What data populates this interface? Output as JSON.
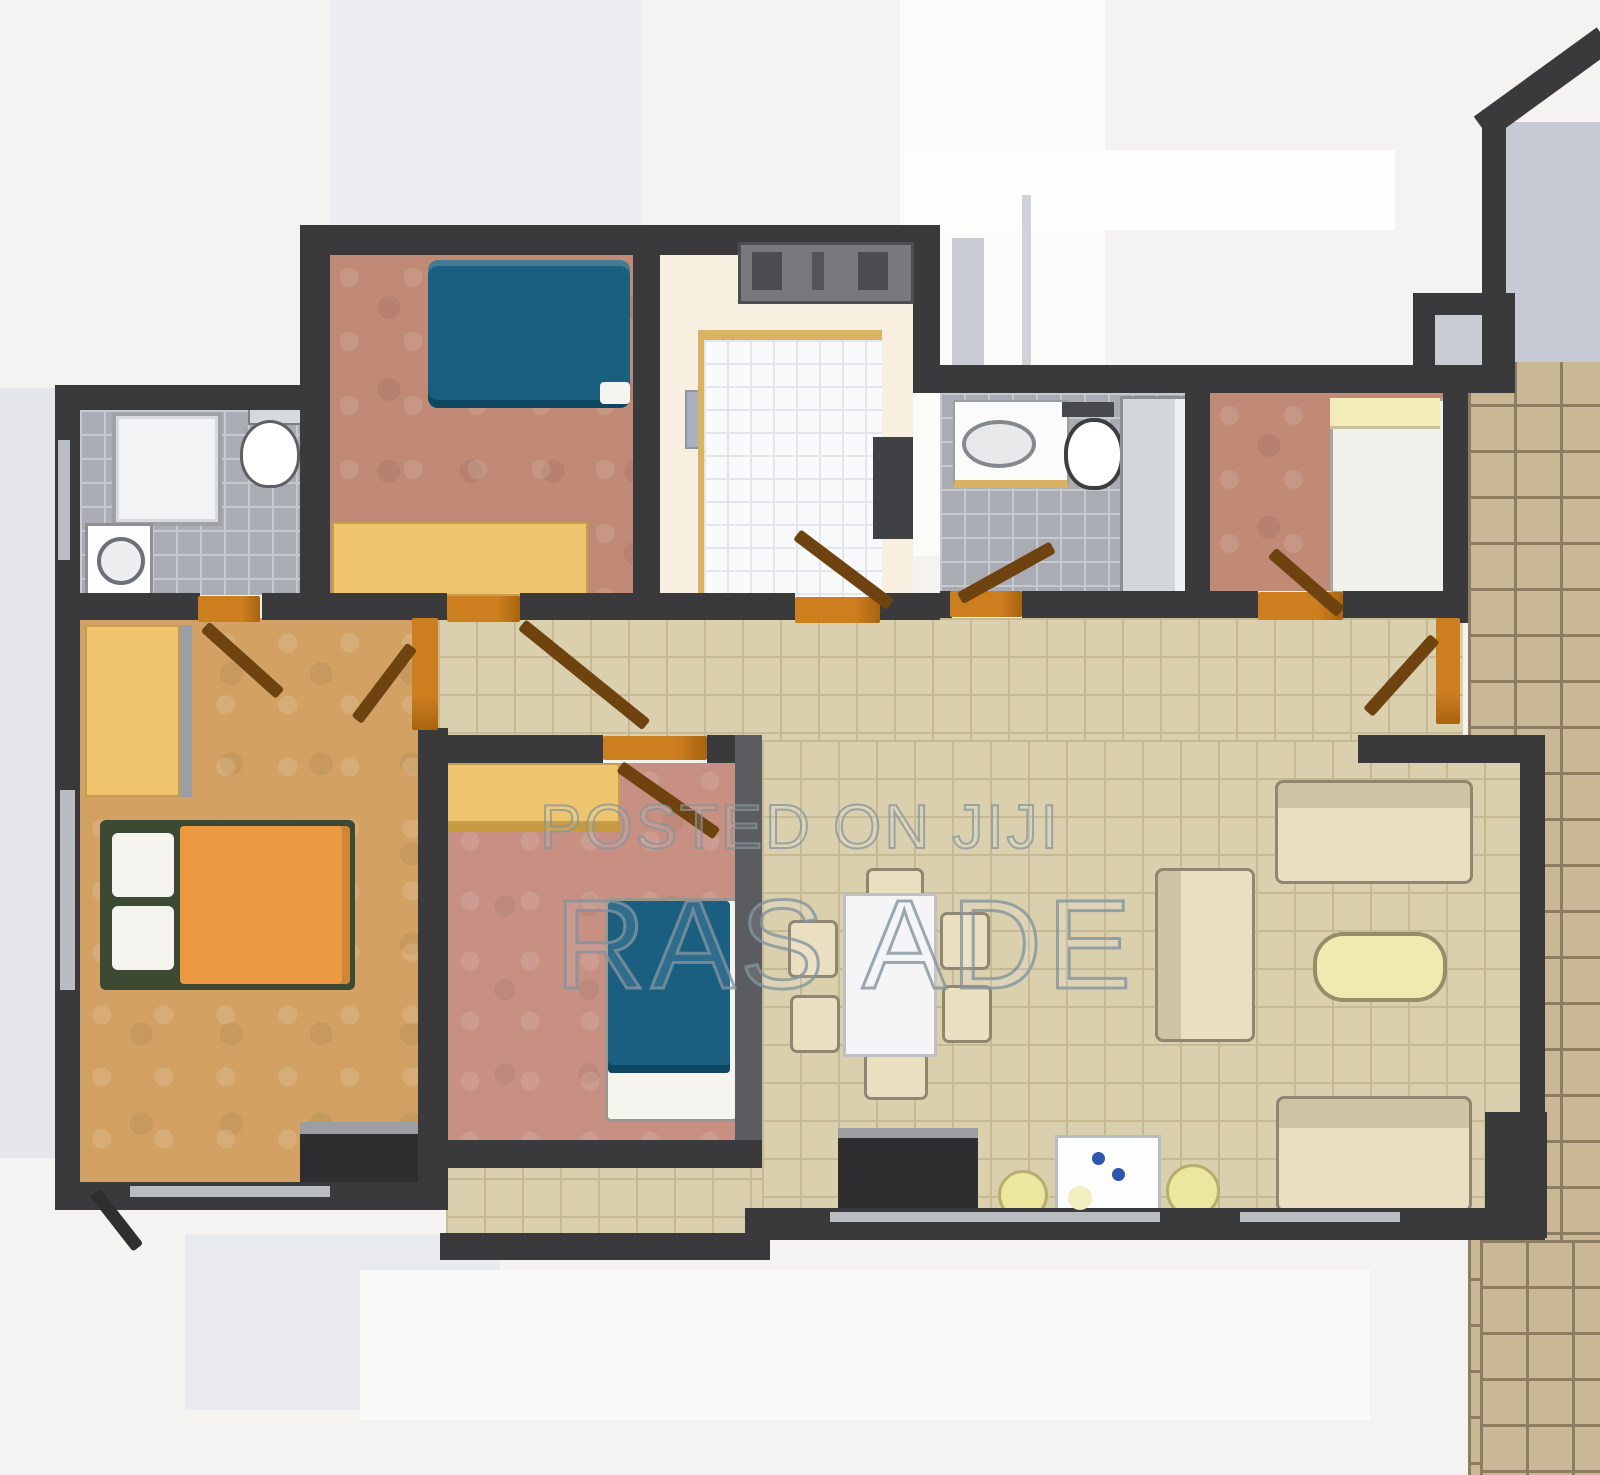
{
  "watermark": {
    "line1": "POSTED ON JIJI",
    "line2": "RAS ADE"
  },
  "palette": {
    "wall": "#3a3a3c",
    "bg": "#f4f3f1",
    "bg_band": "#e4e6e9",
    "bg_shape": "#ebedf0",
    "floor_master": "#d3a163",
    "floor_terracotta": "#c18a76",
    "floor_pink": "#c79082",
    "floor_cream": "#f8efe0",
    "tile_beige": "#dbd0ae",
    "tile_beige_line": "#c6b994",
    "tile_bath": "#a9adb3",
    "tile_bath_line": "#c6c9cd",
    "terrace": "#c9b795",
    "terrace_line": "#8d7d63",
    "bed_blue": "#1a5e80",
    "bed_blue_dark": "#0f4763",
    "bed_orange": "#eb9a41",
    "pillow": "#f6f4ef",
    "wardrobe": "#eec56e",
    "wardrobe_edge": "#c89a3f",
    "door": "#cd7e1f",
    "door_dark": "#6f430f",
    "sofa": "#eadfc0",
    "sofa_edge": "#8f8772",
    "table_white": "#f5f5f7",
    "table_edge": "#bfbfc4",
    "coffee": "#efeab0",
    "stool": "#ece79e",
    "cabinet": "#2e2e30",
    "cabinet_top": "#9d9ea1",
    "appliance": "#fdfdfd",
    "knob_blue": "#2e55b0",
    "shower": "#f2f3f4",
    "fixture_edge": "#6a6d70",
    "corner_gray": "#c6cad4",
    "watermark": "#8c959c"
  },
  "icons": {
    "toilet": "toilet-icon",
    "sink": "sink-icon",
    "shower": "shower-icon",
    "washing_machine": "washing-machine-icon",
    "stove": "stove-icon",
    "cooker": "cooker-icon"
  }
}
